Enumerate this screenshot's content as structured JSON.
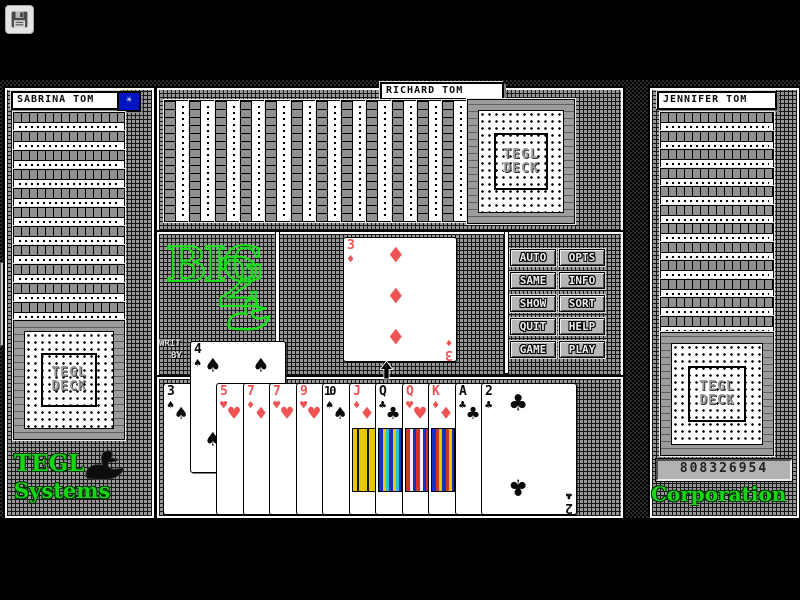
{
  "toolbar": {
    "save_icon": "floppy-disk"
  },
  "side_tab": {
    "icon": "chevron-left"
  },
  "players": {
    "left": {
      "name": "SABRINA TOM",
      "cards_remaining": 12,
      "star_button_icon": "star"
    },
    "top": {
      "name": "RICHARD TOM",
      "cards_remaining": 13
    },
    "right": {
      "name": "JENNIFER TOM",
      "cards_remaining": 13,
      "counter_value": "808326954"
    }
  },
  "card_back": {
    "label_line1": "TEGL",
    "label_line2": "DECK"
  },
  "logo": {
    "word": "BIG",
    "numeral": "2",
    "swan_icon": "swan"
  },
  "credit": {
    "line1": "WRIT",
    "line2": "BY"
  },
  "branding": {
    "left_line1": "TEGL",
    "left_line2": "Systems",
    "right_line": "Corporation",
    "swan_icon": "swan"
  },
  "menu_buttons": [
    "AUTO",
    "OPTS",
    "SAME",
    "INFO",
    "SHOW",
    "SORT",
    "QUIT",
    "HELP",
    "GAME",
    "PLAY"
  ],
  "table": {
    "played_card": {
      "rank": "3",
      "suit": "diamonds",
      "pip_count": 3
    }
  },
  "hand": {
    "cards": [
      {
        "rank": "3",
        "suit": "spades"
      },
      {
        "rank": "4",
        "suit": "spades",
        "raised": true
      },
      {
        "rank": "5",
        "suit": "hearts"
      },
      {
        "rank": "7",
        "suit": "diamonds"
      },
      {
        "rank": "7",
        "suit": "hearts"
      },
      {
        "rank": "9",
        "suit": "hearts"
      },
      {
        "rank": "10",
        "suit": "spades"
      },
      {
        "rank": "J",
        "suit": "diamonds",
        "face": true
      },
      {
        "rank": "Q",
        "suit": "clubs",
        "face": true
      },
      {
        "rank": "Q",
        "suit": "hearts",
        "face": true
      },
      {
        "rank": "K",
        "suit": "diamonds",
        "face": true
      },
      {
        "rank": "A",
        "suit": "clubs"
      },
      {
        "rank": "2",
        "suit": "clubs",
        "fully_visible": true
      }
    ]
  },
  "colors": {
    "card_red": "#ef5454",
    "card_black": "#0a0a0a",
    "brand_green": "#16d616",
    "button_blue": "#0016c4"
  }
}
